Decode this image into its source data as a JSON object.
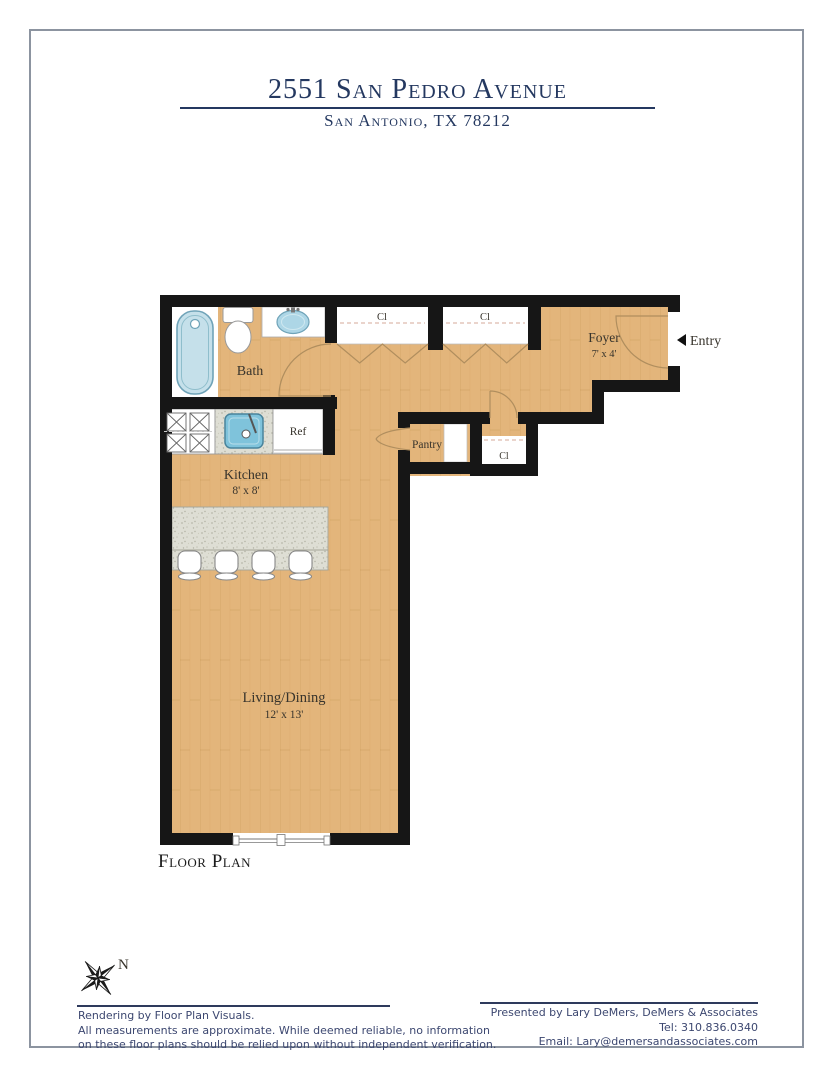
{
  "header": {
    "title": "2551 San Pedro Avenue",
    "subtitle": "San Antonio, TX 78212"
  },
  "plan": {
    "caption": "Floor Plan",
    "entry_label": "Entry",
    "compass_north": "N",
    "rooms": {
      "bath": {
        "label": "Bath"
      },
      "kitchen": {
        "label": "Kitchen",
        "dims": "8' x 8'"
      },
      "living": {
        "label": "Living/Dining",
        "dims": "12' x 13'"
      },
      "foyer": {
        "label": "Foyer",
        "dims": "7' x 4'"
      },
      "pantry": {
        "label": "Pantry"
      },
      "closet_top_left": {
        "label": "Cl"
      },
      "closet_top_right": {
        "label": "Cl"
      },
      "closet_hall": {
        "label": "Cl"
      },
      "refrigerator": {
        "label": "Ref"
      }
    },
    "colors": {
      "wall": "#161616",
      "floor_wood": "#E3B57B",
      "fixture_blue": "#BFDFEA",
      "counter_gray": "#DEDED4",
      "title_navy": "#243860",
      "footer_navy": "#3C4770",
      "page_border_gray": "#8C94A0"
    }
  },
  "footer": {
    "left_lines": [
      "Rendering by Floor Plan Visuals.",
      "All measurements are approximate. While deemed reliable, no information",
      "on these floor plans should be relied upon without independent verification."
    ],
    "right_lines": [
      "Presented by Lary DeMers, DeMers & Associates",
      "Tel: 310.836.0340",
      "Email: Lary@demersandassociates.com"
    ]
  }
}
